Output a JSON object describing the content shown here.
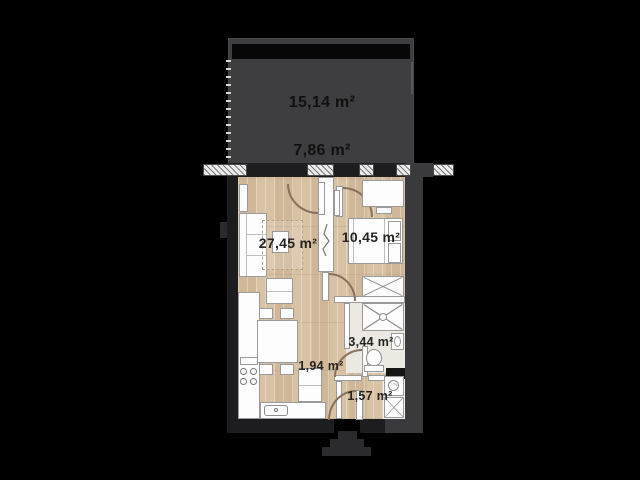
{
  "plan": {
    "title": "apartment-floor-plan",
    "rooms": {
      "terrace_total": {
        "area": "15,14 m²"
      },
      "terrace_usable": {
        "area": "7,86 m²"
      },
      "living": {
        "area": "27,45 m²"
      },
      "bedroom": {
        "area": "10,45 m²"
      },
      "bathroom": {
        "area": "3,44 m²"
      },
      "hall": {
        "area": "1,94 m²"
      },
      "wc": {
        "area": "1,57 m²"
      }
    },
    "colors": {
      "background": "#000000",
      "terrace_fill": "#3e3e40",
      "railing_wall": "#070707",
      "wall_dark": "#1d1d1f",
      "wall_grey": "#3a3a3c",
      "floor_wood": "#d8c2a4",
      "floor_tile": "#ebe9e2",
      "furniture": "#fdfdfd",
      "door_arc": "#86715d",
      "label_text": "#262420"
    }
  }
}
